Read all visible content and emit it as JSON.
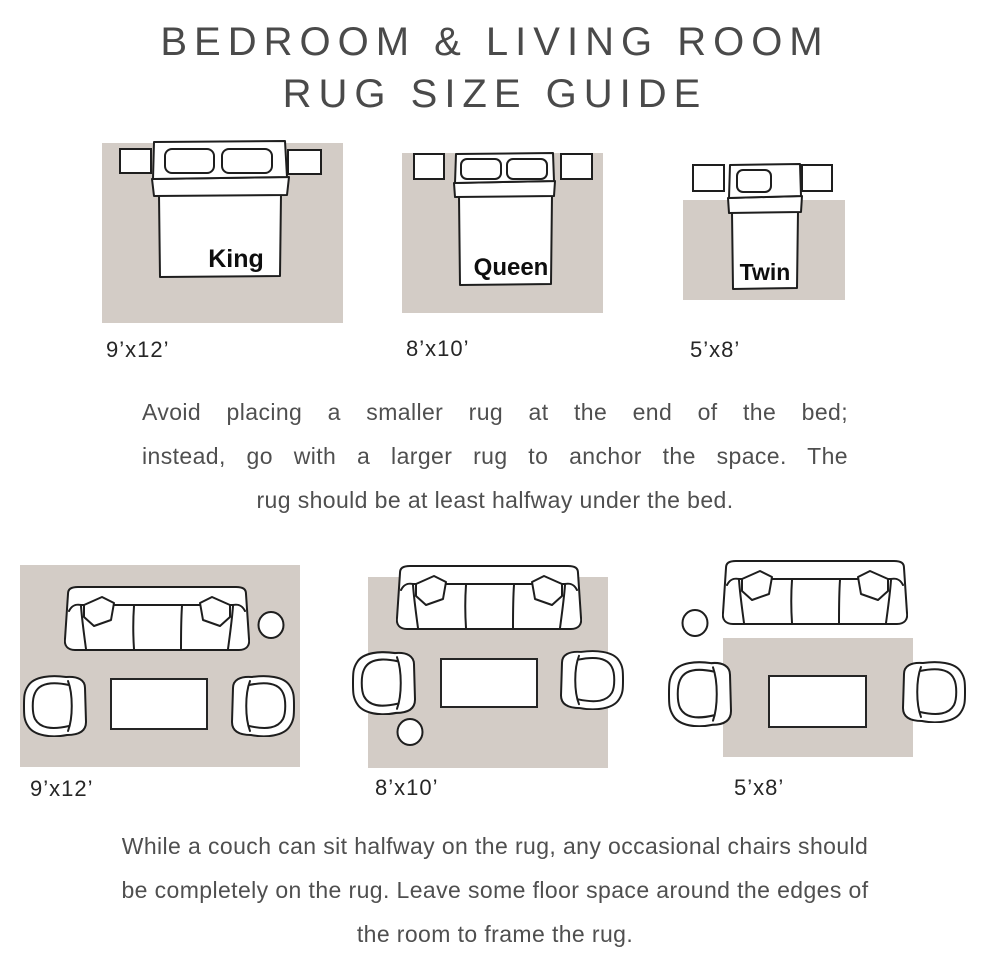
{
  "title": {
    "line1": "BEDROOM & LIVING ROOM",
    "line2": "RUG SIZE GUIDE"
  },
  "colors": {
    "rug": "#d3ccc6",
    "outline": "#1e1e1e",
    "title_text": "#4a4a4a",
    "body_text": "#4f4f4f",
    "size_label_text": "#262626"
  },
  "bedroom": {
    "diagrams": [
      {
        "bed_label": "King",
        "size_label": "9’x12’"
      },
      {
        "bed_label": "Queen",
        "size_label": "8’x10’"
      },
      {
        "bed_label": "Twin",
        "size_label": "5’x8’"
      }
    ],
    "tip": {
      "lines": [
        "Avoid placing a smaller rug at the end of the bed;",
        "instead, go with a larger rug to anchor the space. The",
        "rug should be at least halfway under the bed."
      ]
    }
  },
  "living": {
    "diagrams": [
      {
        "size_label": "9’x12’"
      },
      {
        "size_label": "8’x10’"
      },
      {
        "size_label": "5’x8’"
      }
    ],
    "tip": {
      "lines": [
        "While a couch can sit halfway on the rug, any occasional chairs should",
        "be completely on the rug. Leave some floor space around the edges of",
        "the room to frame the rug."
      ]
    }
  }
}
